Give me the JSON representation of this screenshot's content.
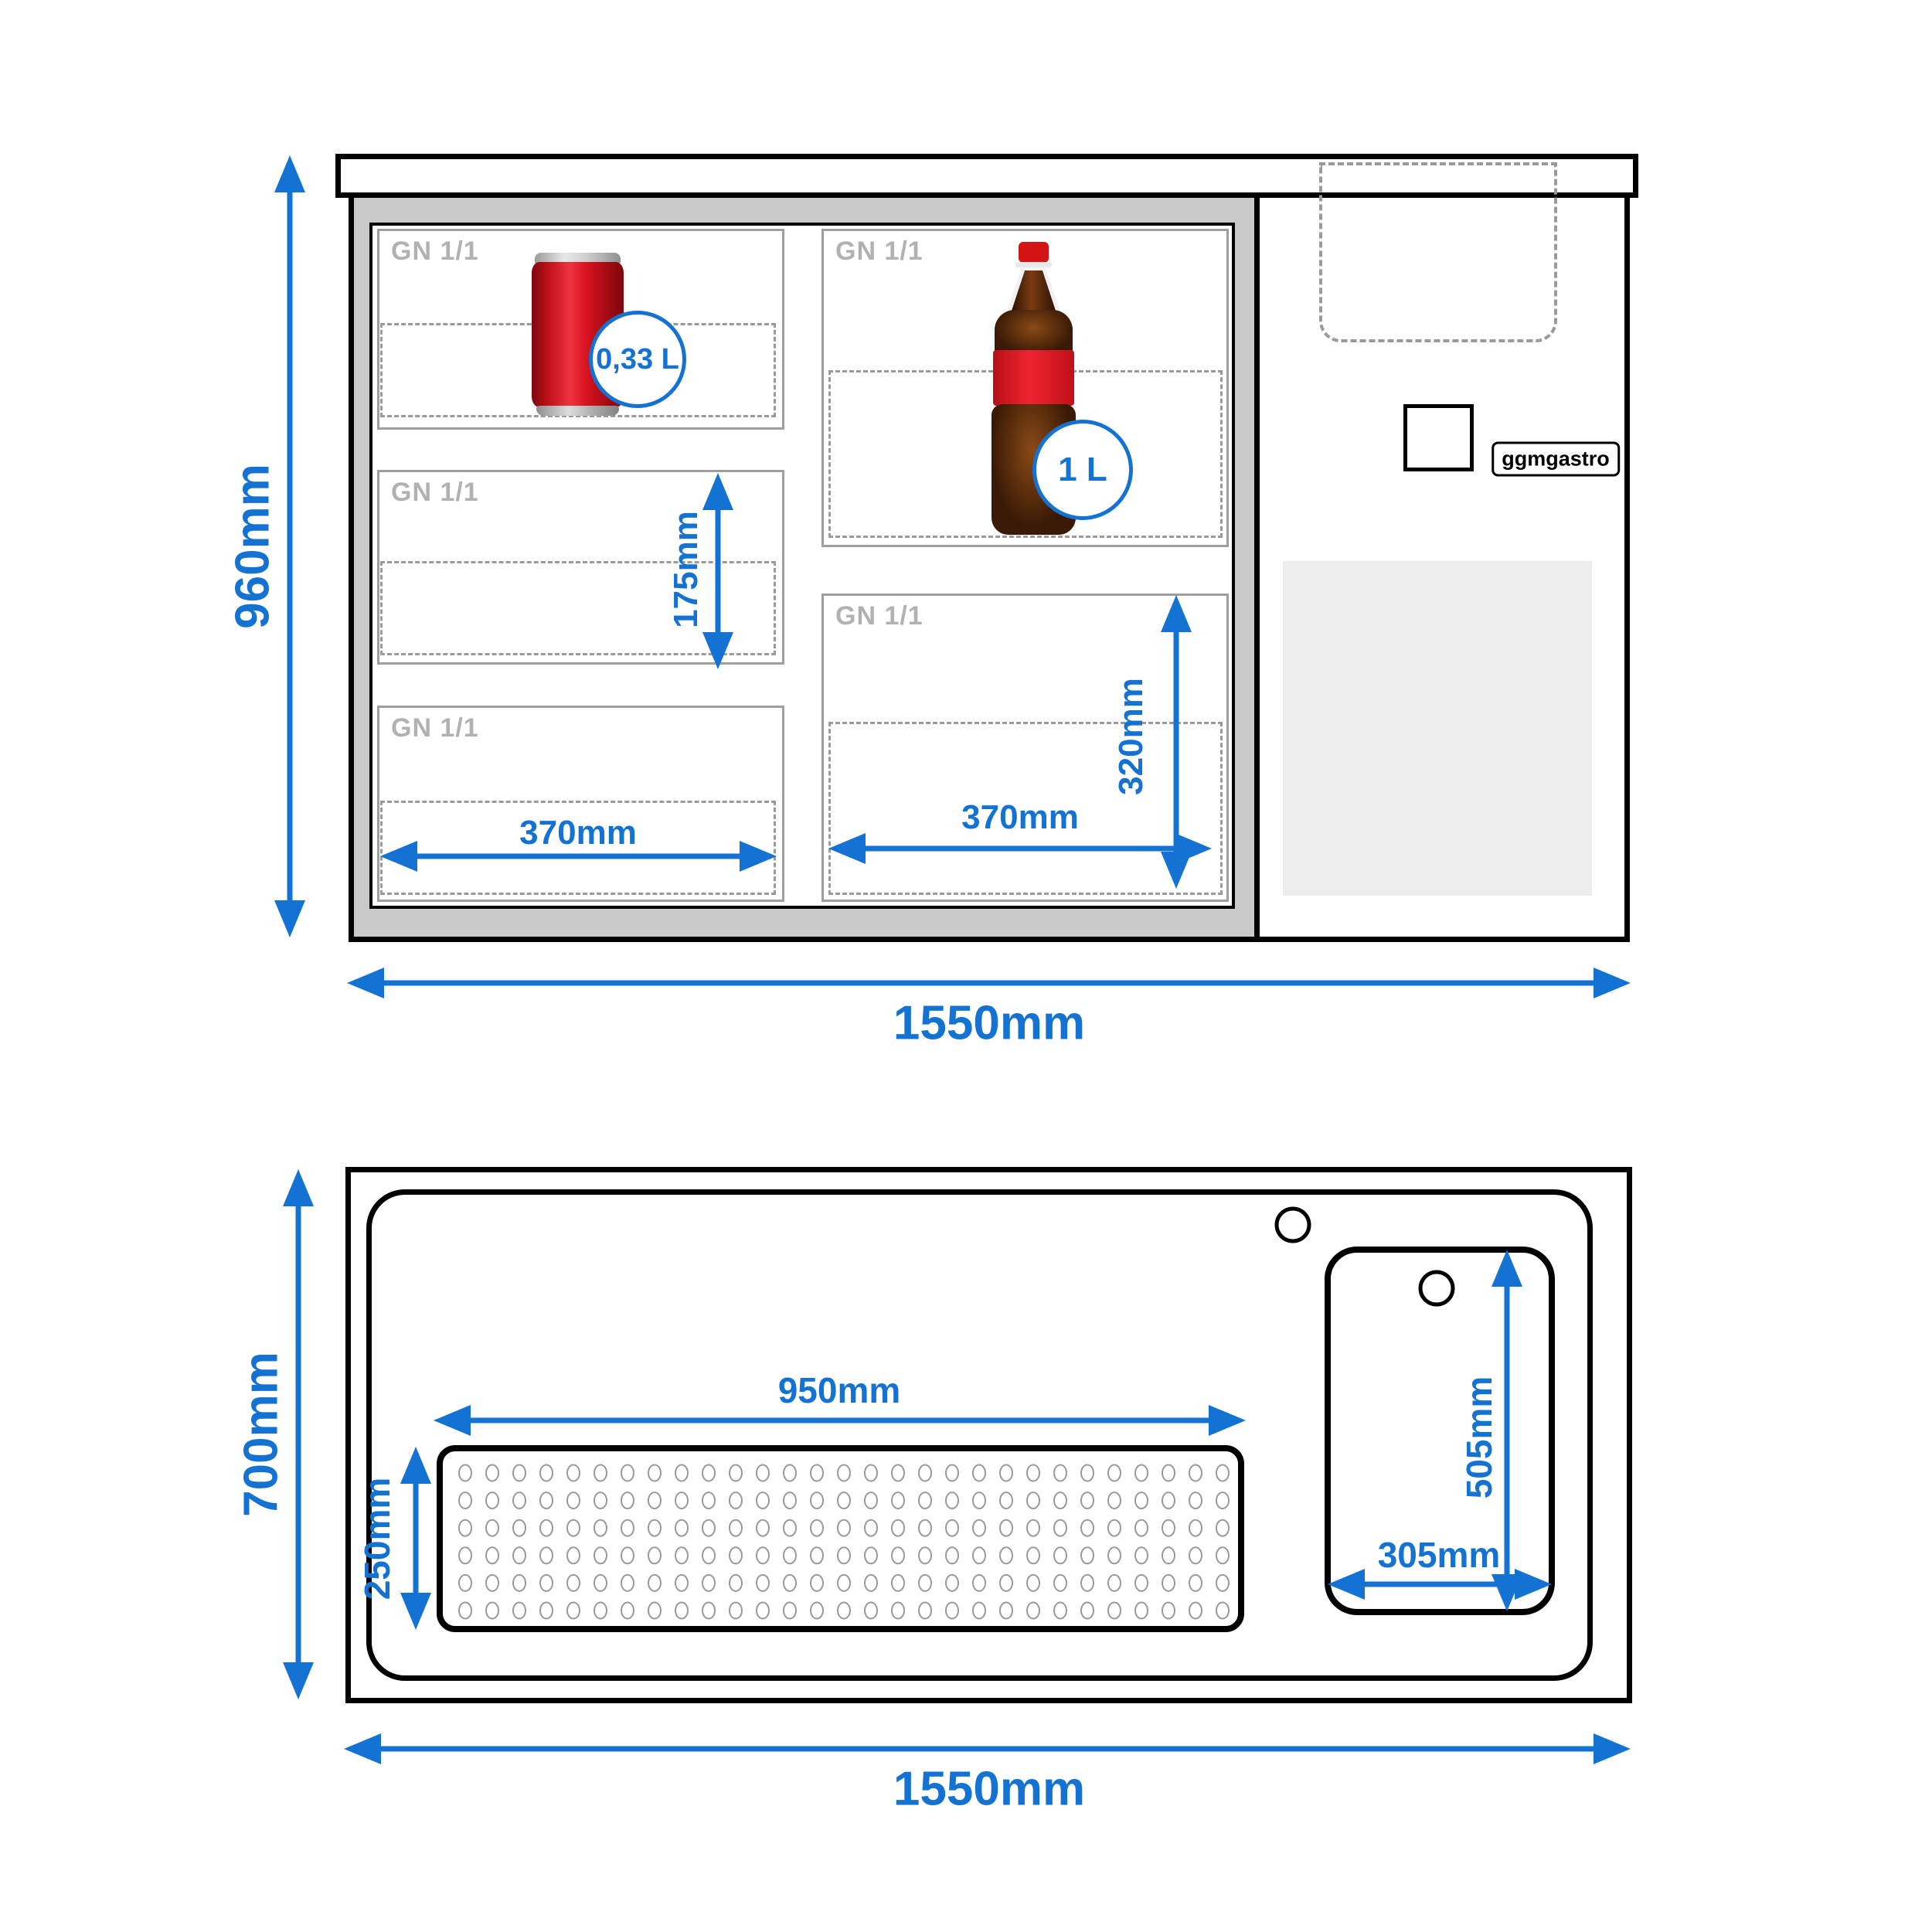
{
  "brand": {
    "badge": "ggmgastro"
  },
  "front_view": {
    "compartments": [
      {
        "label": "GN 1/1"
      },
      {
        "label": "GN 1/1"
      },
      {
        "label": "GN 1/1"
      },
      {
        "label": "GN 1/1"
      },
      {
        "label": "GN 1/1"
      }
    ],
    "can_badge": "0,33 L",
    "bottle_badge": "1 L",
    "dims": {
      "height": "960mm",
      "width": "1550mm",
      "shelf": "175mm",
      "pan_w_left": "370mm",
      "pan_w_right": "370mm",
      "pan_h": "320mm"
    }
  },
  "top_view": {
    "dims": {
      "depth": "700mm",
      "width": "1550mm",
      "drainer_w": "950mm",
      "drainer_d": "250mm",
      "sink_d": "505mm",
      "sink_w": "305mm"
    }
  },
  "colors": {
    "accent": "#1473d2",
    "frame_gray": "#c9c9c9",
    "line_gray": "#9e9e9e",
    "label_gray": "#b1b1b1",
    "dash_gray": "#9a9a9a",
    "panel_gray": "#ededed",
    "hole_gray": "#999999",
    "can_red": "#d8101c",
    "bottle_brown": "#3a1a06",
    "bottle_red": "#e01620"
  }
}
